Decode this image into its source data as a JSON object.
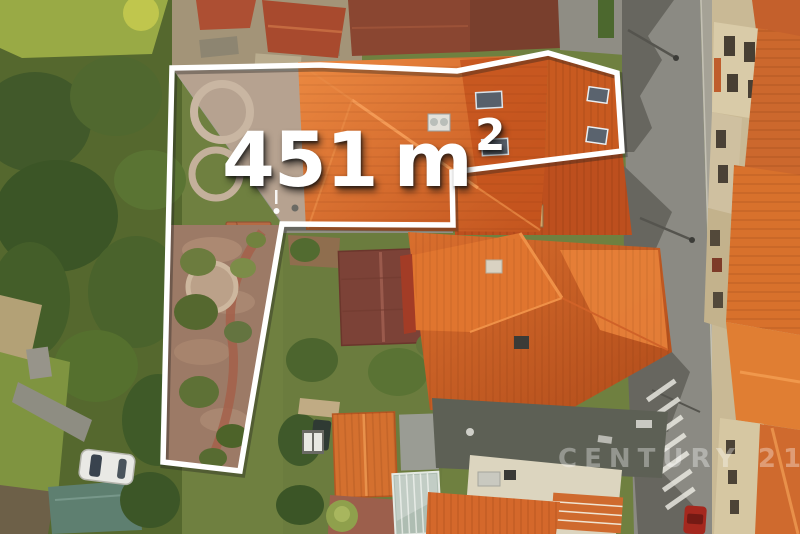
{
  "photo": {
    "kind": "aerial-property-photo",
    "area_label": {
      "value": "451",
      "unit": "m",
      "superscript": "2"
    },
    "watermark": "CENTURY 21",
    "colors": {
      "outline": "#ffffff",
      "label_text": "#ffffff",
      "roof_orange": "#d4662a",
      "street_gray": "#8b8a83",
      "vegetation_green": "#55682e"
    }
  }
}
